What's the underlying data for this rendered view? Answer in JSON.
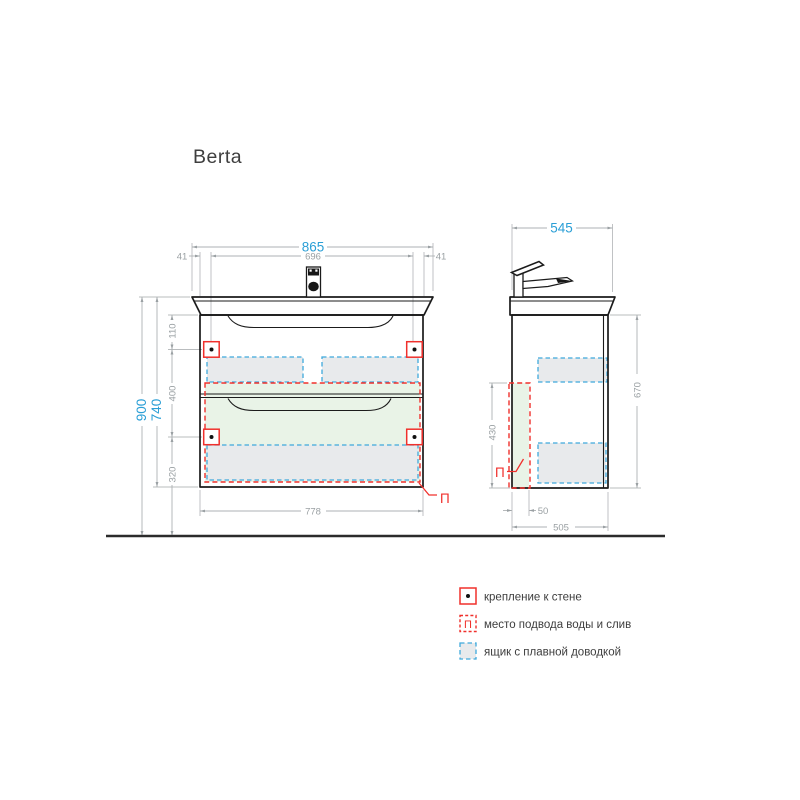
{
  "title": "Berta",
  "colors": {
    "dimension_accent": "#2b9fd6",
    "marking_red": "#f0302c",
    "drawer_dash_blue": "#3fa9dc",
    "drawer_fill": "#e8eaec",
    "water_zone_fill": "#e9f3e7"
  },
  "front_view": {
    "dims": {
      "total_width": "865",
      "side_offset_left": "41",
      "inner_width": "696",
      "side_offset_right": "41",
      "mount_height": "900",
      "unit_height": "740",
      "top_to_mount": "110",
      "mount_spacing": "400",
      "mount_to_floor": "320",
      "cabinet_width": "778"
    },
    "plumbing_mark": "П"
  },
  "side_view": {
    "dims": {
      "total_depth": "545",
      "cabinet_height": "670",
      "plumbing_zone_height": "430",
      "plumbing_zone_depth": "50",
      "cabinet_depth": "505"
    },
    "plumbing_mark": "П"
  },
  "legend": {
    "items": [
      {
        "id": "wall-mount",
        "label": "крепление к стене"
      },
      {
        "id": "water-supply",
        "symbol": "П",
        "label": "место подвода воды и слив"
      },
      {
        "id": "soft-close-drawer",
        "label": "ящик с плавной доводкой"
      }
    ]
  }
}
